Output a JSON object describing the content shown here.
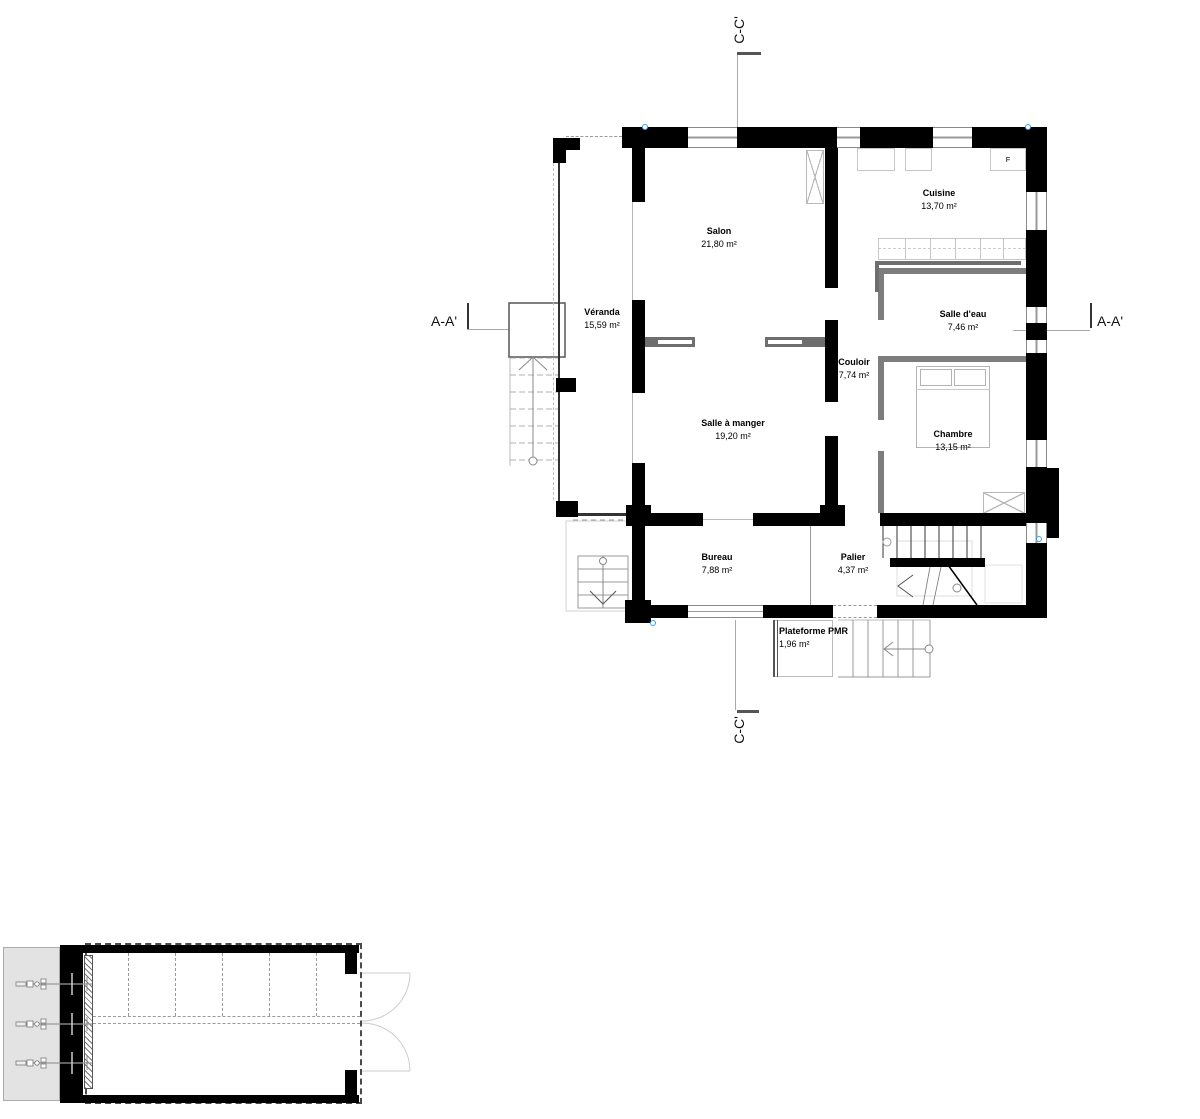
{
  "sections": {
    "aa": "A-A'",
    "cc": "C-C'"
  },
  "rooms": [
    {
      "name": "Véranda",
      "area": "15,59 m²"
    },
    {
      "name": "Salon",
      "area": "21,80 m²"
    },
    {
      "name": "Cuisine",
      "area": "13,70 m²"
    },
    {
      "name": "Salle d'eau",
      "area": "7,46 m²"
    },
    {
      "name": "Couloir",
      "area": "7,74 m²"
    },
    {
      "name": "Salle à manger",
      "area": "19,20 m²"
    },
    {
      "name": "Chambre",
      "area": "13,15 m²"
    },
    {
      "name": "Bureau",
      "area": "7,88 m²"
    },
    {
      "name": "Palier",
      "area": "4,37 m²"
    },
    {
      "name": "Plateforme PMR",
      "area": "1,96 m²"
    }
  ],
  "labels": {
    "fridge": "F"
  },
  "colors": {
    "wall": "#000000",
    "partition": "#7d7d7d",
    "counter_edge": "#6e6e6e",
    "furniture_outline": "#c6c6c6",
    "selection_handle": "#33a1ff",
    "platform_fill": "#e3e3e3"
  }
}
